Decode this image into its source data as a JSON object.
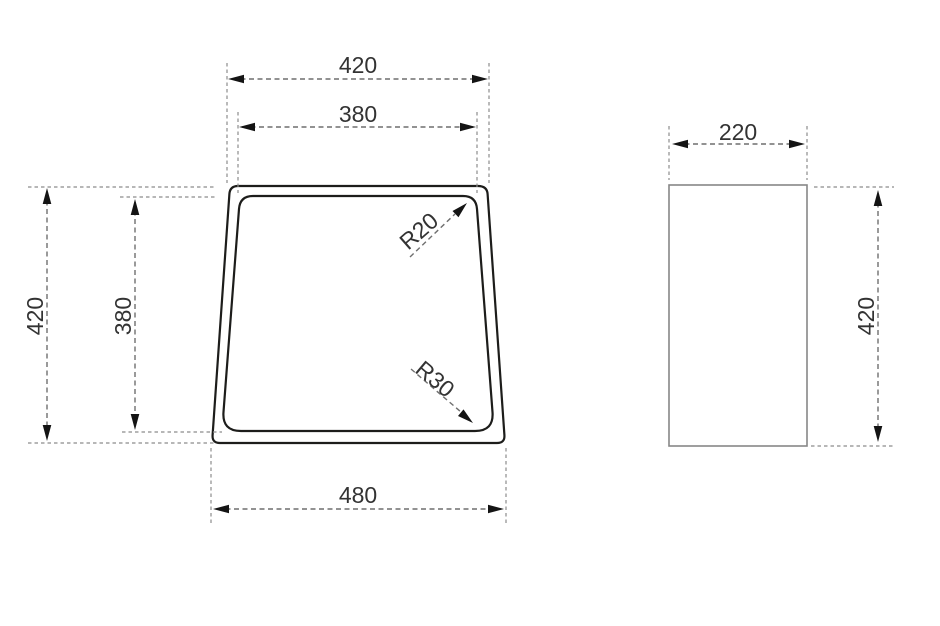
{
  "drawing": {
    "top_view": {
      "name": "basin-top-view",
      "dims": {
        "top_outer": "420",
        "top_inner": "380",
        "left_outer": "420",
        "left_inner": "380",
        "bottom": "480",
        "radius_top": "R20",
        "radius_bottom": "R30"
      }
    },
    "side_view": {
      "name": "basin-side-view",
      "dims": {
        "width": "220",
        "height": "420"
      }
    },
    "colors": {
      "outline": "#1d1d1b",
      "secondary_outline": "#878787",
      "dimension_line": "#6f6f6f",
      "extension_line": "#8c8c8c",
      "arrowhead": "#141414",
      "text": "#333333",
      "background": "#ffffff"
    }
  }
}
